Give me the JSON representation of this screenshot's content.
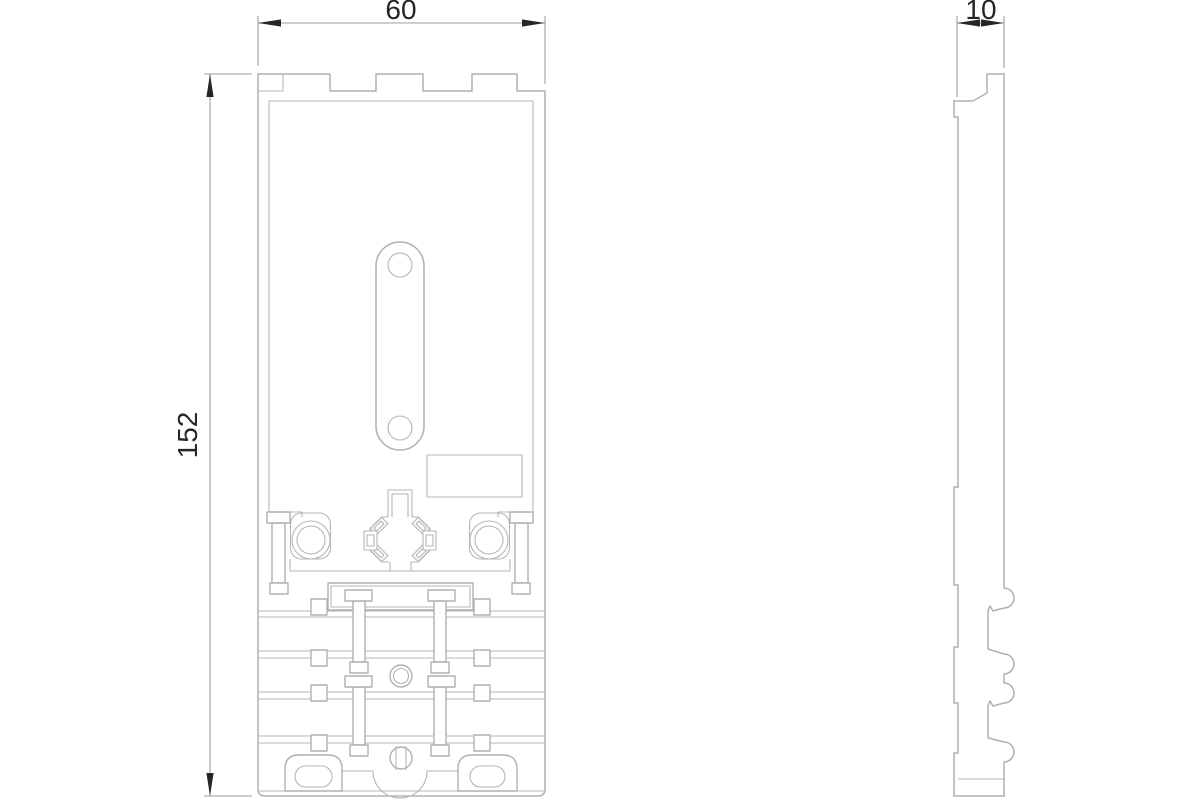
{
  "drawing": {
    "dimensions": {
      "width": "60",
      "height": "152",
      "depth": "10"
    },
    "colors": {
      "background": "#ffffff",
      "part_line": "#b0b0b0",
      "dimension_line": "#9e9e9e",
      "annotation_text": "#262626"
    }
  }
}
